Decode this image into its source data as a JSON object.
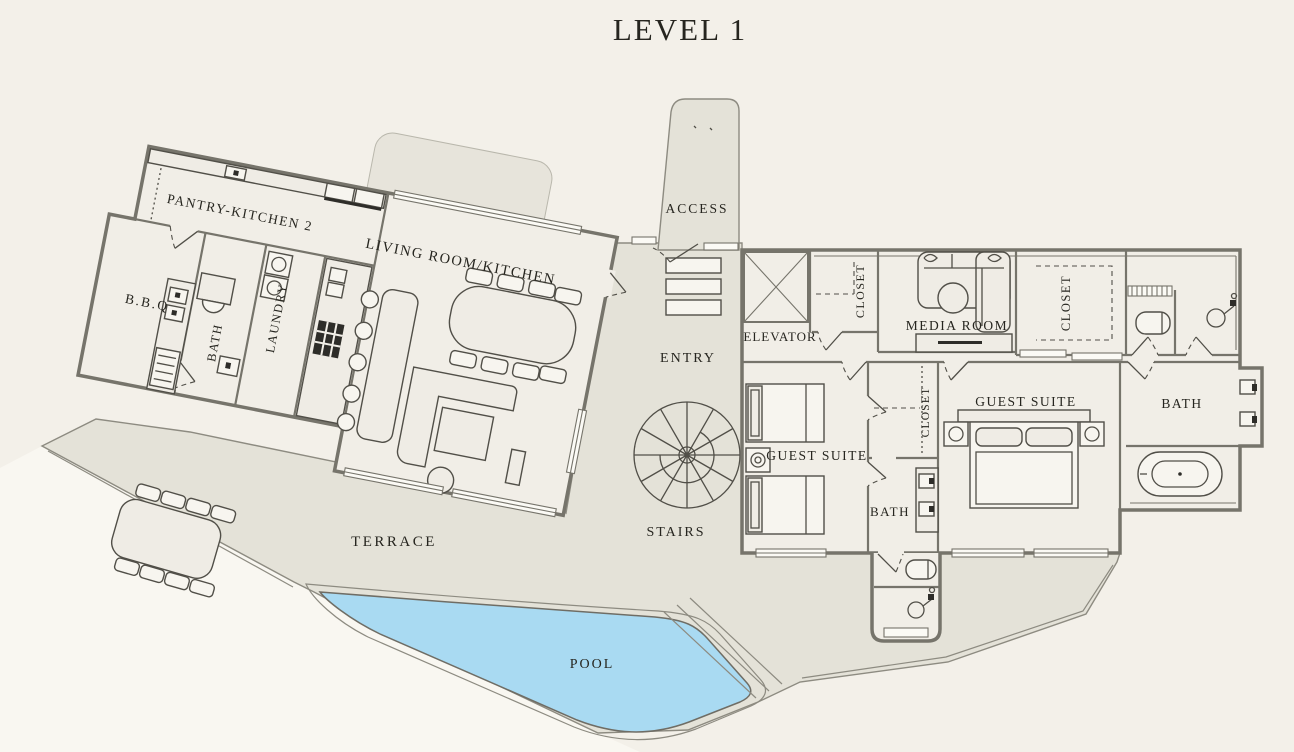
{
  "title": "LEVEL 1",
  "floor_plan": {
    "rooms": {
      "pantry_kitchen": "PANTRY-KITCHEN 2",
      "bbq": "B.B.Q",
      "bath": "BATH",
      "laundry": "LAUNDRY",
      "living_room_kitchen": "LIVING ROOM/KITCHEN",
      "access": "ACCESS",
      "entry": "ENTRY",
      "stairs": "STAIRS",
      "elevator": "ELEVATOR",
      "closet": "CLOSET",
      "media_room": "MEDIA ROOM",
      "guest_suite": "GUEST SUITE",
      "terrace": "TERRACE",
      "pool": "POOL"
    },
    "colors": {
      "background": "#f3f0e9",
      "room_fill": "#f1eee7",
      "wall": "#76746b",
      "hardscape": "#e4e2d8",
      "pool_water": "#a9daf2",
      "text": "#26251f"
    }
  }
}
